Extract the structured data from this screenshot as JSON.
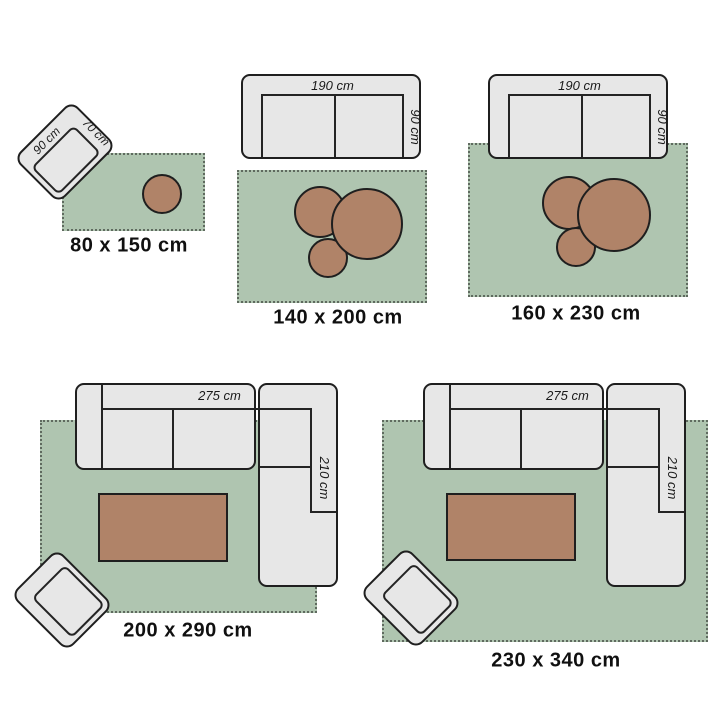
{
  "diagram": {
    "kind": "rug-size-guide",
    "colors": {
      "rug_fill": "#afc5b0",
      "rug_border": "#5f6a5f",
      "furniture_fill": "#e7e7e7",
      "accent_table_fill": "#b08368",
      "outline": "#1f1f1f",
      "text": "#101010"
    }
  },
  "scenes": [
    {
      "size_label": "80 x 150 cm",
      "chair_width_label": "90 cm",
      "chair_depth_label": "70 cm"
    },
    {
      "size_label": "140 x 200 cm",
      "sofa_width_label": "190 cm",
      "sofa_depth_label": "90 cm"
    },
    {
      "size_label": "160 x 230 cm",
      "sofa_width_label": "190 cm",
      "sofa_depth_label": "90 cm"
    },
    {
      "size_label": "200 x 290 cm",
      "sofa_width_label": "275 cm",
      "sofa_depth_label": "210 cm"
    },
    {
      "size_label": "230 x 340 cm",
      "sofa_width_label": "275 cm",
      "sofa_depth_label": "210 cm"
    }
  ]
}
